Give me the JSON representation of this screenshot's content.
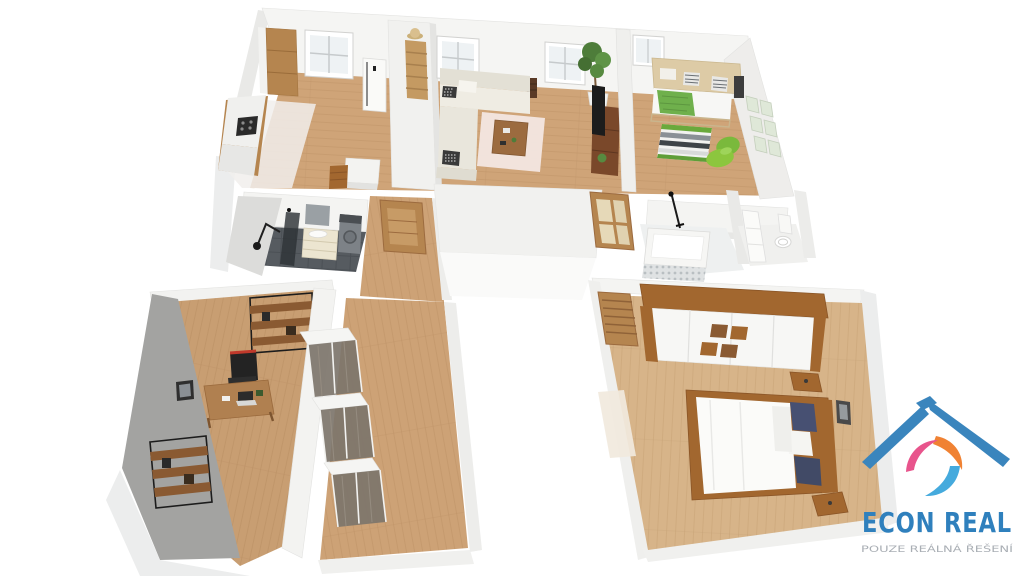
{
  "meta": {
    "view": "3d-floorplan-axonometric-render",
    "background": "#ffffff"
  },
  "logo": {
    "name": "ECON REAL",
    "tagline": "POUZE REÁLNÁ ŘEŠENÍ",
    "colors": {
      "roof": "#3a85bd",
      "name_text": "#2f80bd",
      "tagline_text": "#a9aeb4",
      "swirl_orange": "#f08233",
      "swirl_pink": "#e8548c",
      "swirl_blue": "#45aadd"
    }
  },
  "palette": {
    "wall": "#f4f4f2",
    "wall_shadow": "#e6e6e4",
    "wall_gray_accent": "#a3a3a1",
    "floor_wood": "#cfa478",
    "floor_wood_bedroom": "#d7b489",
    "bathroom_floor_dark": "#565b60",
    "sofa_cream": "#e9e6dc",
    "accent_green": "#8cc63e",
    "blanket_green": "#6fb04c",
    "pillow_navy": "#475072",
    "wood_furniture": "#b5854f",
    "wood_dark": "#8a5a32"
  },
  "rooms": [
    {
      "id": "kitchen",
      "furniture": [
        "cabinets",
        "countertop",
        "stove",
        "fridge",
        "island",
        "ladder-shelf",
        "hat",
        "window"
      ]
    },
    {
      "id": "living-room",
      "furniture": [
        "corner-sofa",
        "checkered-pillows",
        "rug",
        "coffee-table",
        "tv-stand",
        "tv",
        "potted-plant",
        "windows",
        "wall-shelf"
      ]
    },
    {
      "id": "kids-room",
      "furniture": [
        "bed-with-headboard-storage",
        "green-blanket",
        "striped-rug",
        "bean-bag",
        "wall-frames",
        "window"
      ]
    },
    {
      "id": "bathroom",
      "furniture": [
        "shower-glass",
        "mirror",
        "vanity-sink",
        "washing-machine",
        "wall-lamp"
      ]
    },
    {
      "id": "hallway",
      "furniture": [
        "wooden-door"
      ]
    },
    {
      "id": "bathroom-2",
      "furniture": [
        "bathtub",
        "mosaic-panel",
        "shower-fixture",
        "glass-door"
      ]
    },
    {
      "id": "wc",
      "furniture": [
        "toilet",
        "tall-cabinet"
      ]
    },
    {
      "id": "office",
      "furniture": [
        "desk",
        "laptop",
        "gaming-chair",
        "industrial-shelf",
        "industrial-shelf-2",
        "wall-picture",
        "gray-accent-wall"
      ]
    },
    {
      "id": "closet-corridor",
      "furniture": [
        "sliding-glass-wardrobe",
        "sliding-glass-wardrobe",
        "sliding-glass-wardrobe"
      ]
    },
    {
      "id": "master-bedroom",
      "furniture": [
        "double-bed",
        "navy-pillows",
        "wardrobe",
        "nightstand",
        "nightstand",
        "louvered-door",
        "pale-rug",
        "wall-picture"
      ]
    }
  ]
}
